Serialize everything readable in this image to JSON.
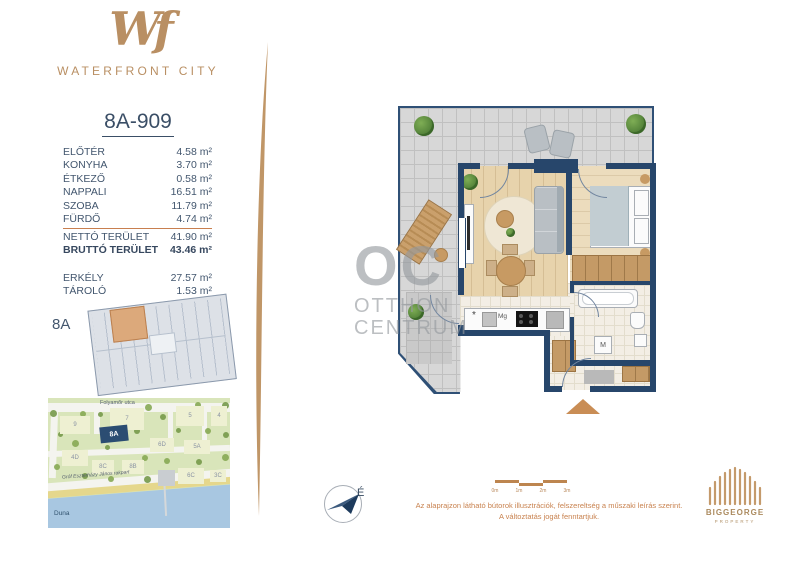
{
  "brand": {
    "monogram": "Wf",
    "name": "WATERFRONT CITY"
  },
  "unit": {
    "id": "8A-909"
  },
  "areas": {
    "rooms": [
      {
        "label": "ELŐTÉR",
        "value": "4.58 m²"
      },
      {
        "label": "KONYHA",
        "value": "3.70 m²"
      },
      {
        "label": "ÉTKEZŐ",
        "value": "0.58 m²"
      },
      {
        "label": "NAPPALI",
        "value": "16.51 m²"
      },
      {
        "label": "SZOBA",
        "value": "11.79 m²"
      },
      {
        "label": "FÜRDŐ",
        "value": "4.74 m²"
      }
    ],
    "totals": [
      {
        "label": "NETTÓ TERÜLET",
        "value": "41.90 m²",
        "bold": false
      },
      {
        "label": "BRUTTÓ TERÜLET",
        "value": "43.46 m²",
        "bold": true
      }
    ],
    "extras": [
      {
        "label": "ERKÉLY",
        "value": "27.57 m²"
      },
      {
        "label": "TÁROLÓ",
        "value": "1.53 m²"
      }
    ]
  },
  "overview": {
    "label": "8A"
  },
  "map": {
    "street_top": "Folyamőr utca",
    "street_embankment": "Gróf Eszterházy János rakpart",
    "river": "Duna",
    "buildings": [
      {
        "label": "9",
        "x": 12,
        "y": 18,
        "w": 30,
        "h": 18
      },
      {
        "label": "7",
        "x": 62,
        "y": 10,
        "w": 34,
        "h": 22
      },
      {
        "label": "5",
        "x": 128,
        "y": 8,
        "w": 28,
        "h": 20
      },
      {
        "label": "4",
        "x": 163,
        "y": 8,
        "w": 16,
        "h": 20
      },
      {
        "label": "8A",
        "x": 52,
        "y": 28,
        "w": 28,
        "h": 16,
        "highlight": true,
        "rotate": -6
      },
      {
        "label": "6D",
        "x": 102,
        "y": 40,
        "w": 24,
        "h": 14
      },
      {
        "label": "5A",
        "x": 136,
        "y": 42,
        "w": 26,
        "h": 14
      },
      {
        "label": "4D",
        "x": 14,
        "y": 52,
        "w": 26,
        "h": 16
      },
      {
        "label": "8C",
        "x": 44,
        "y": 62,
        "w": 22,
        "h": 14
      },
      {
        "label": "8B",
        "x": 74,
        "y": 62,
        "w": 22,
        "h": 14
      },
      {
        "label": "6C",
        "x": 130,
        "y": 70,
        "w": 26,
        "h": 16
      },
      {
        "label": "3C",
        "x": 162,
        "y": 72,
        "w": 16,
        "h": 12
      }
    ]
  },
  "plan_labels": {
    "fridge": "*",
    "dishwasher": "Mg",
    "washer": "M"
  },
  "compass": {
    "north": "É"
  },
  "scale": {
    "ticks": [
      "0m",
      "1m",
      "2m",
      "3m"
    ]
  },
  "disclaimer": {
    "line1": "Az alaprajzon látható bútorok illusztrációk, felszereltség a műszaki leírás szerint.",
    "line2": "A változtatás jogát fenntartjuk."
  },
  "watermark": {
    "monogram": "OC",
    "line1": "OTTHON",
    "line2": "CENTRUM"
  },
  "developer": {
    "name": "BIGGEORGE",
    "division": "PROPERTY"
  },
  "colors": {
    "accent": "#b98f63",
    "wall_navy": "#27466b",
    "orange": "#c8824f",
    "map_highlight": "#2b4d72"
  }
}
